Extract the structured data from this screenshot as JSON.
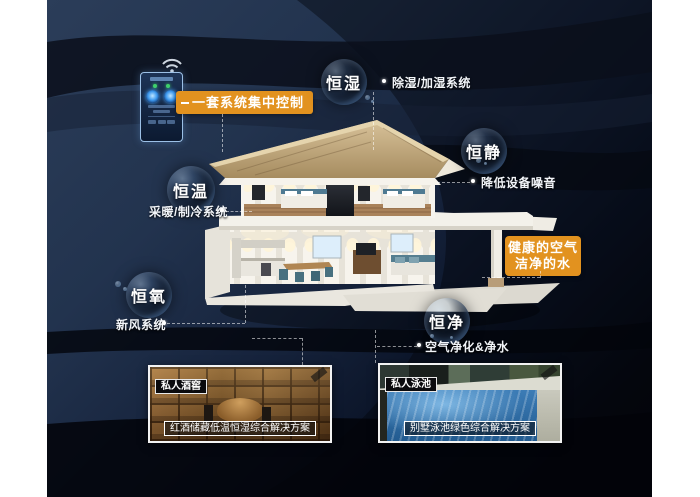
{
  "bubbles": [
    {
      "label": "恒湿"
    },
    {
      "label": "恒静"
    },
    {
      "label": "恒温"
    },
    {
      "label": "恒氧"
    },
    {
      "label": "恒净"
    }
  ],
  "callouts": {
    "humidity": "除湿/加湿系统",
    "quiet": "降低设备噪音",
    "temperature": "采暖/制冷系统",
    "oxygen": "新风系统",
    "purity": "空气净化&净水"
  },
  "badges": {
    "central_control": "一套系统集中控制",
    "healthy_air": "健康的空气",
    "clean_water": "洁净的水"
  },
  "photos": [
    {
      "tag": "私人酒窖",
      "caption": "红酒储藏低温恒湿综合解决方案"
    },
    {
      "tag": "私人泳池",
      "caption": "别墅泳池绿色综合解决方案"
    }
  ],
  "icons": {
    "wifi": "wifi-arcs"
  },
  "colors": {
    "accent_orange": "#e2921f",
    "background_navy": "#22334e",
    "background_black": "#04060d",
    "roof_tan": "#c0a87e",
    "pool_blue": "#2e6fa8",
    "cellar_wood": "#8a5f30"
  }
}
